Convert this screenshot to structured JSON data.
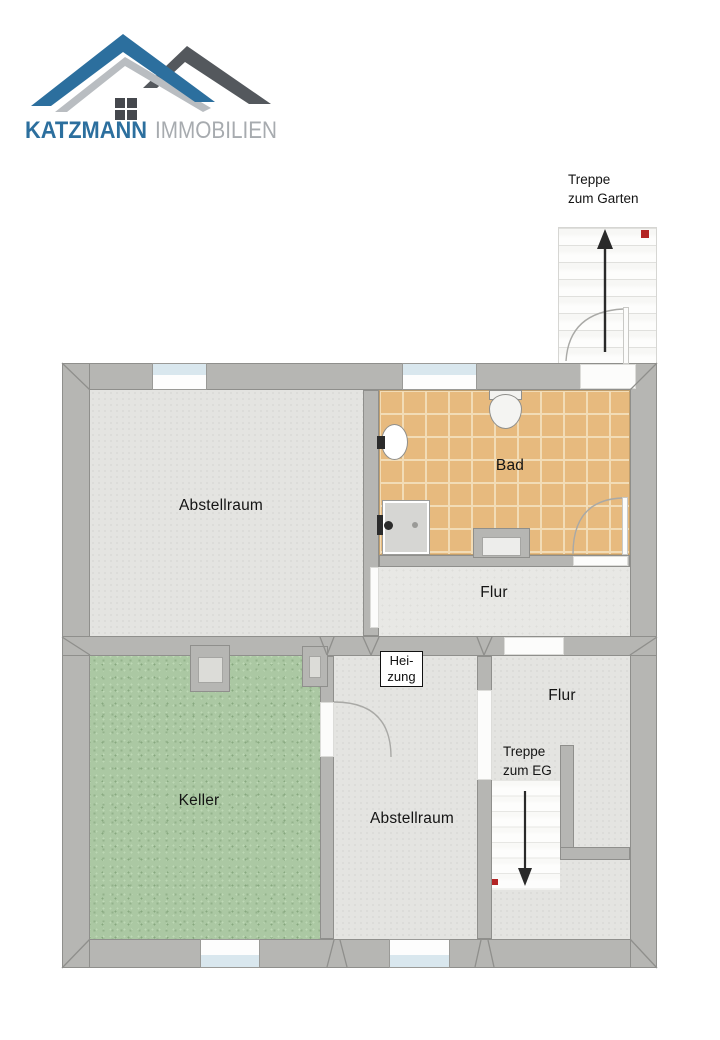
{
  "logo": {
    "brand": "KATZMANN",
    "brand_suffix": "IMMOBILIEN",
    "colors": {
      "blue": "#2C6F9E",
      "dark_roof": "#54585D",
      "silver": "#B9BDC1",
      "suffix_gray": "#A7ABAF"
    }
  },
  "rooms": {
    "abstellraum_top": "Abstellraum",
    "bad": "Bad",
    "flur_upper": "Flur",
    "keller": "Keller",
    "abstellraum_bottom": "Abstellraum",
    "flur_lower": "Flur"
  },
  "heizung": {
    "line1": "Hei-",
    "line2": "zung"
  },
  "stairs": {
    "garden": {
      "line1": "Treppe",
      "line2": "zum Garten"
    },
    "eg": {
      "line1": "Treppe",
      "line2": "zum EG"
    }
  },
  "colors": {
    "wall": "#B6B6B3",
    "tile": "#E7BA7E",
    "keller_floor": "#ABC8A3",
    "gray_floor": "#E4E4E1",
    "marker_red": "#B32424",
    "window_glass": "#D9E7EE"
  }
}
